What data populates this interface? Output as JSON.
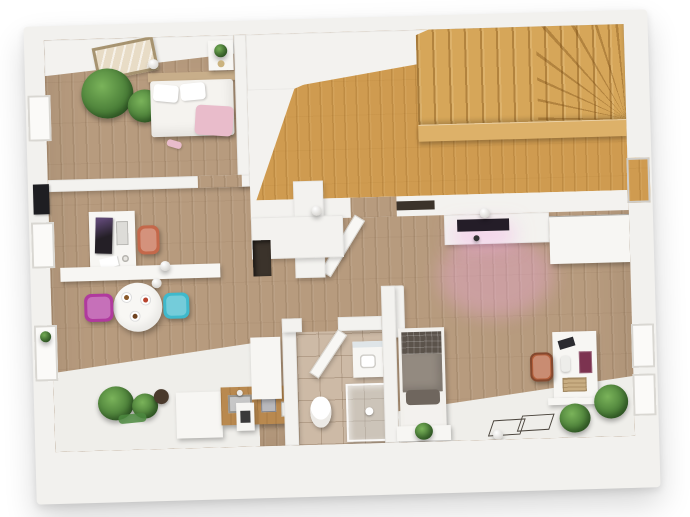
{
  "scene": {
    "description": "3D rendered top-down floor plan of an attic apartment, white walls, wood floors, no visible text labels",
    "view": "bird's-eye 3D render on white background"
  },
  "palette": {
    "background": "#ffffff",
    "wall": "#f3f2ef",
    "floor_wood_weathered": "#b79b7e",
    "floor_wood_golden": "#cf9b50",
    "stair_fascia": "#ddb169",
    "bathroom_tile": "#cdbaa6",
    "floor_white": "#efeeea",
    "chair_orange": "#c4684a",
    "chair_magenta": "#b03a9e",
    "chair_teal": "#3fb9cc",
    "chair_rust": "#b5603c",
    "tv_screen": "#241d28",
    "monitor_screen": "#241f26",
    "pink_glow": "#f5aae6",
    "throw_pink": "#e9bccb",
    "bedding_white": "#f5f3ef",
    "bedding_gray": "#938a80",
    "bedding_plaid": "#5b534b",
    "headboard_wood": "#c8ae8a",
    "counter_wood": "#b9894f",
    "niche_dark": "#3b332b",
    "plant_green": "#4c8a3f"
  },
  "rooms": [
    {
      "id": "bedroom-1",
      "position": "top-left",
      "floor": "weathered wood",
      "contents": [
        "double bed with white bedding and pink throw",
        "wood headboard",
        "nightstand with flowers",
        "two potted plants",
        "skylight panel",
        "ceiling lamp"
      ]
    },
    {
      "id": "stair-hall",
      "position": "top-right",
      "floor": "golden wood",
      "contents": [
        "winder staircase in corner",
        "raised golden wood landing",
        "wall niche"
      ]
    },
    {
      "id": "office-dining",
      "position": "left-middle",
      "floor": "weathered wood",
      "contents": [
        "desk with monitor and keyboard",
        "orange desk chair",
        "white sideboard",
        "two pendant lamps",
        "round dining table with plates",
        "magenta chair",
        "teal chair"
      ]
    },
    {
      "id": "kitchen",
      "position": "bottom-left",
      "floor": "white",
      "contents": [
        "white base cabinet",
        "wood countertop with sink and faucet",
        "small appliances",
        "tall white cabinet",
        "floor plants",
        "green mat"
      ]
    },
    {
      "id": "bathroom",
      "position": "bottom-center",
      "floor": "beige tile",
      "contents": [
        "toilet",
        "glass shower enclosure",
        "washbasin with mirror",
        "open door"
      ]
    },
    {
      "id": "bedroom-2-entry",
      "position": "right",
      "floor": "weathered wood + white entry strip",
      "contents": [
        "single bed with gray bedding",
        "bench with plant",
        "wall-mounted TV with pink glow",
        "white wardrobe",
        "desk with shelf and accessories",
        "rust wicker chair",
        "plants",
        "two doormats",
        "ceiling lamps"
      ]
    }
  ],
  "openings": {
    "left_wall_windows": 3,
    "left_wall_picture": 1,
    "right_wall_windows": 2,
    "right_wall_niche": 1,
    "open_doors": 2
  },
  "lighting": {
    "ceiling_sphere_lamps": 6,
    "small_dark_pendant": 1,
    "tv_pink_light": true
  }
}
